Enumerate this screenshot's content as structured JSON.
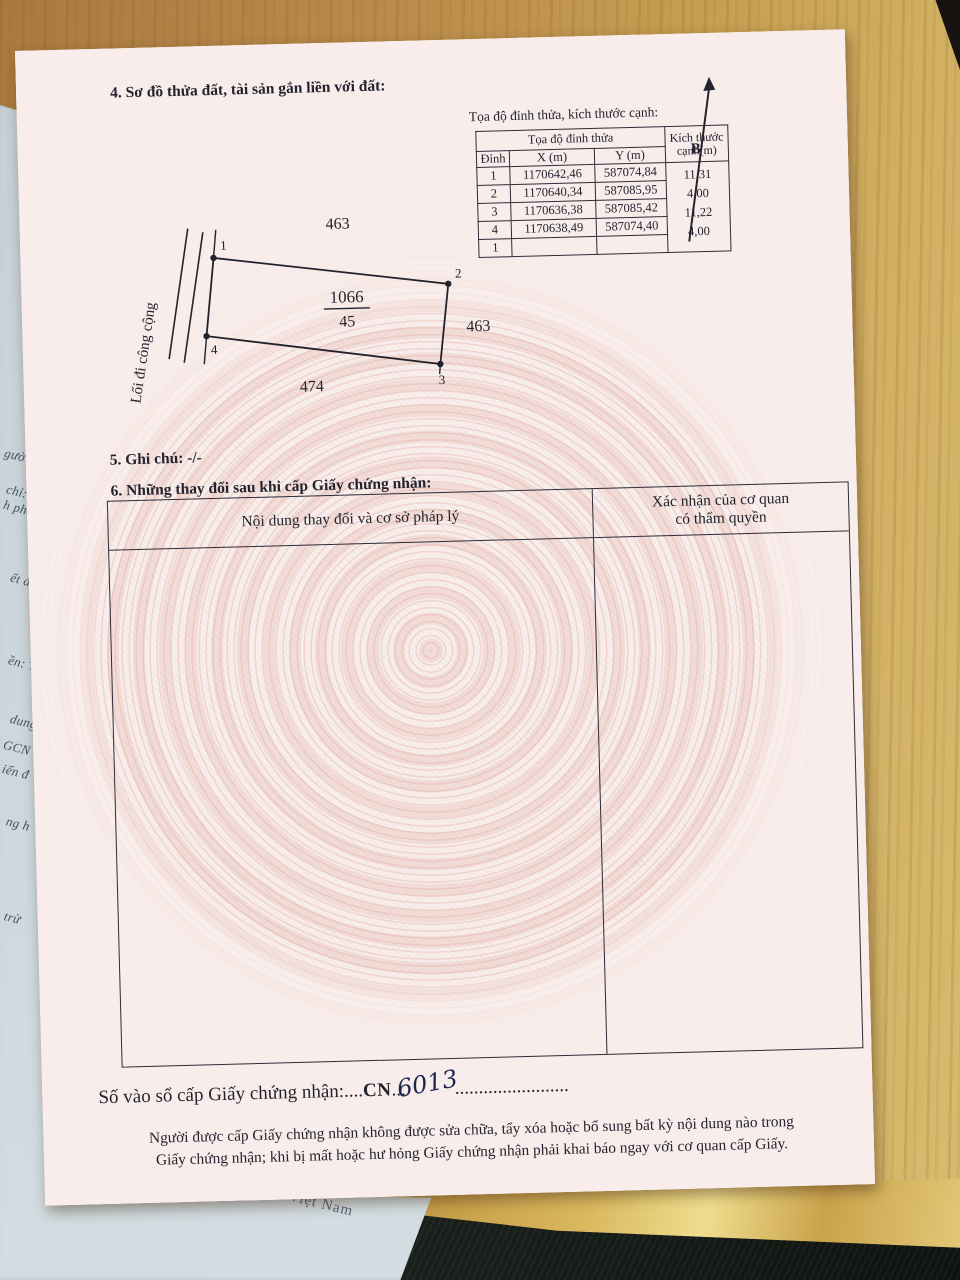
{
  "page": {
    "section4_heading": "4. Sơ đồ thửa đất, tài sản gắn liền với đất:",
    "north_label": "B",
    "coord_table": {
      "caption": "Tọa độ đỉnh thửa, kích thước cạnh:",
      "header_group": "Tọa độ đỉnh thửa",
      "header_kt": "Kích thước cạnh(m)",
      "col_dinh": "Đỉnh",
      "col_x": "X (m)",
      "col_y": "Y (m)",
      "rows": [
        {
          "dinh": "1",
          "x": "1170642,46",
          "y": "587074,84"
        },
        {
          "dinh": "2",
          "x": "1170640,34",
          "y": "587085,95"
        },
        {
          "dinh": "3",
          "x": "1170636,38",
          "y": "587085,42"
        },
        {
          "dinh": "4",
          "x": "1170638,49",
          "y": "587074,40"
        },
        {
          "dinh": "1",
          "x": "",
          "y": ""
        }
      ],
      "edges": [
        "11,31",
        "4,00",
        "11,22",
        "4,00"
      ]
    },
    "diagram": {
      "parcel_number": "1066",
      "area": "45",
      "neighbor_top": "463",
      "neighbor_right": "463",
      "neighbor_bottom": "474",
      "path_label": "Lối đi công cộng",
      "vertices": [
        "1",
        "2",
        "3",
        "4"
      ]
    },
    "section5_heading": "5. Ghi chú: -/-",
    "section6_heading": "6. Những thay đổi sau khi cấp Giấy chứng nhận:",
    "section6_table": {
      "col_content": "Nội dung thay đổi và cơ sở pháp lý",
      "col_confirm_line1": "Xác nhận của cơ quan",
      "col_confirm_line2": "có thẩm quyền"
    },
    "serial_line": {
      "label": "Số vào sổ cấp Giấy chứng nhận:",
      "dots1": "....",
      "code": "CN",
      "dots2": "...",
      "handwritten": "6013",
      "dots3": "........................"
    },
    "footer_line1": "Người được cấp Giấy chứng nhận không được sửa chữa, tẩy xóa hoặc bổ sung bất kỳ nội dung nào trong",
    "footer_line2": "Giấy chứng nhận; khi bị mất hoặc hư hỏng Giấy chứng nhận phải khai báo ngay với cơ quan cấp Giấy."
  },
  "underlying": {
    "fragments": [
      "Th",
      "Thu",
      "Thu",
      "gười nộ",
      "chỉ: Từ",
      "h phố H",
      "ết định",
      "ền: Tr",
      "dung",
      "GCN",
      "iến đ",
      "ng h",
      "trừ"
    ],
    "bottom_fragment": "Việt Nam"
  },
  "colors": {
    "paper_pink": "#f7ebe8",
    "guilloche": "#e7b9b0",
    "ink": "#23232e",
    "wood": "#b8894a",
    "underlay_blue": "#ccd7dd",
    "dark_area": "#141a16"
  }
}
